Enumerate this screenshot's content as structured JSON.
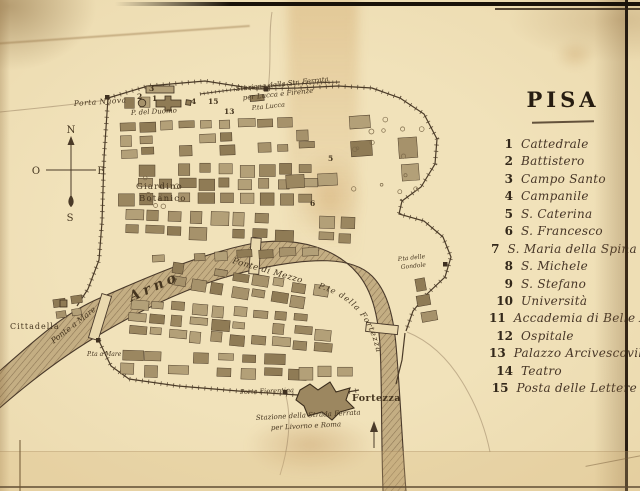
{
  "legend": {
    "title": "PISA",
    "items": [
      {
        "num": "1",
        "label": "Cattedrale"
      },
      {
        "num": "2",
        "label": "Battistero"
      },
      {
        "num": "3",
        "label": "Campo Santo"
      },
      {
        "num": "4",
        "label": "Campanile"
      },
      {
        "num": "5",
        "label": "S. Caterina"
      },
      {
        "num": "6",
        "label": "S. Francesco"
      },
      {
        "num": "7",
        "label": "S. Maria della Spina"
      },
      {
        "num": "8",
        "label": "S. Michele"
      },
      {
        "num": "9",
        "label": "S. Stefano"
      },
      {
        "num": "10",
        "label": "Università"
      },
      {
        "num": "11",
        "label": "Accademia di Belle Arti"
      },
      {
        "num": "12",
        "label": "Ospitale"
      },
      {
        "num": "13",
        "label": "Palazzo Arcivescovile"
      },
      {
        "num": "14",
        "label": "Teatro"
      },
      {
        "num": "15",
        "label": "Posta delle Lettere"
      }
    ]
  },
  "map": {
    "labels": {
      "porta_nuova": "Porta Nuova",
      "p_del_duomo": "P. del Duomo",
      "station_north_1": "Stazione della Str. Ferrata",
      "station_north_2": "per Lucca e Firenze",
      "porta_lucca": "P.ta Lucca",
      "giardino_1": "Giardino",
      "giardino_2": "Botanico",
      "arno": "Arno",
      "ponte_a_mare": "Ponte a Mare",
      "pta_a_mare": "P.ta a Mare",
      "cittadella": "Cittadella",
      "ponte_di_mezzo": "Ponte di Mezzo",
      "pte_della_fortezza": "P.te della Fortezza",
      "pta_delle_gondole_1": "P.ta delle",
      "pta_delle_gondole_2": "Gondole",
      "porta_fiorentina": "Porta Fiorentina",
      "fortezza": "Fortezza",
      "station_south_1": "Stazione della Strada Ferrata",
      "station_south_2": "per Livorno e Roma"
    },
    "compass": {
      "north": "N",
      "south": "S",
      "east": "E",
      "west": "O"
    },
    "markers": [
      "1",
      "2",
      "3",
      "4",
      "5",
      "6",
      "7",
      "13",
      "15"
    ]
  },
  "colors": {
    "paper": "#eddfb8",
    "ink": "#3b2f20",
    "block_fill": "#ab9770",
    "river_fill": "#c4ae83",
    "page_edge": "#1a120a"
  }
}
